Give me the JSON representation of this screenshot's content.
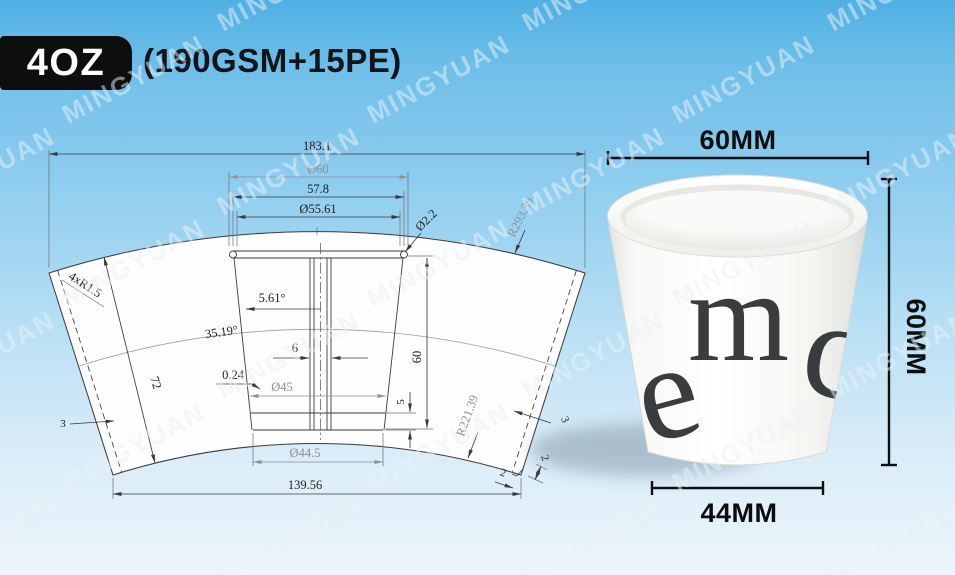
{
  "watermark": {
    "text": "MINGYUAN"
  },
  "header": {
    "badge_label": "4OZ",
    "spec_label": "(190GSM+15PE)"
  },
  "colors": {
    "bg_top": "#4fb0e3",
    "bg_bottom": "#ecf5fb",
    "badge_bg": "#0e0e0e",
    "badge_text": "#ffffff",
    "drawing_line": "#3a3a3a",
    "dim_gray": "#8f8f8f",
    "photo_dim": "#101010",
    "letter_color": "#3a3d3f"
  },
  "drawing": {
    "dims": {
      "total_width": "183.1",
      "top_outer_dia": "Ø60",
      "rim_outer_width": "57.8",
      "top_inner_dia": "Ø55.61",
      "rim_roll_dia": "Ø2.2",
      "top_arc_radius": "R293.39",
      "corner_radius": "4xR1.5",
      "fan_angle": "35.19°",
      "wall_angle": "5.61°",
      "slant_height": "72",
      "seam_width": "6",
      "thickness": "0.24",
      "mid_dia": "Ø45",
      "cup_height": "60",
      "bottom_band": "5",
      "bottom_dia": "Ø44.5",
      "bottom_width": "139.56",
      "bottom_arc_radius": "R221.39",
      "seam_left": "3",
      "seam_right": "3",
      "corner_cut_w": "2",
      "corner_cut_h": "2"
    }
  },
  "photo": {
    "dims": {
      "top": "60MM",
      "height": "60MM",
      "bottom": "44MM"
    },
    "letters": {
      "m": "m",
      "c": "c",
      "e": "e"
    }
  }
}
